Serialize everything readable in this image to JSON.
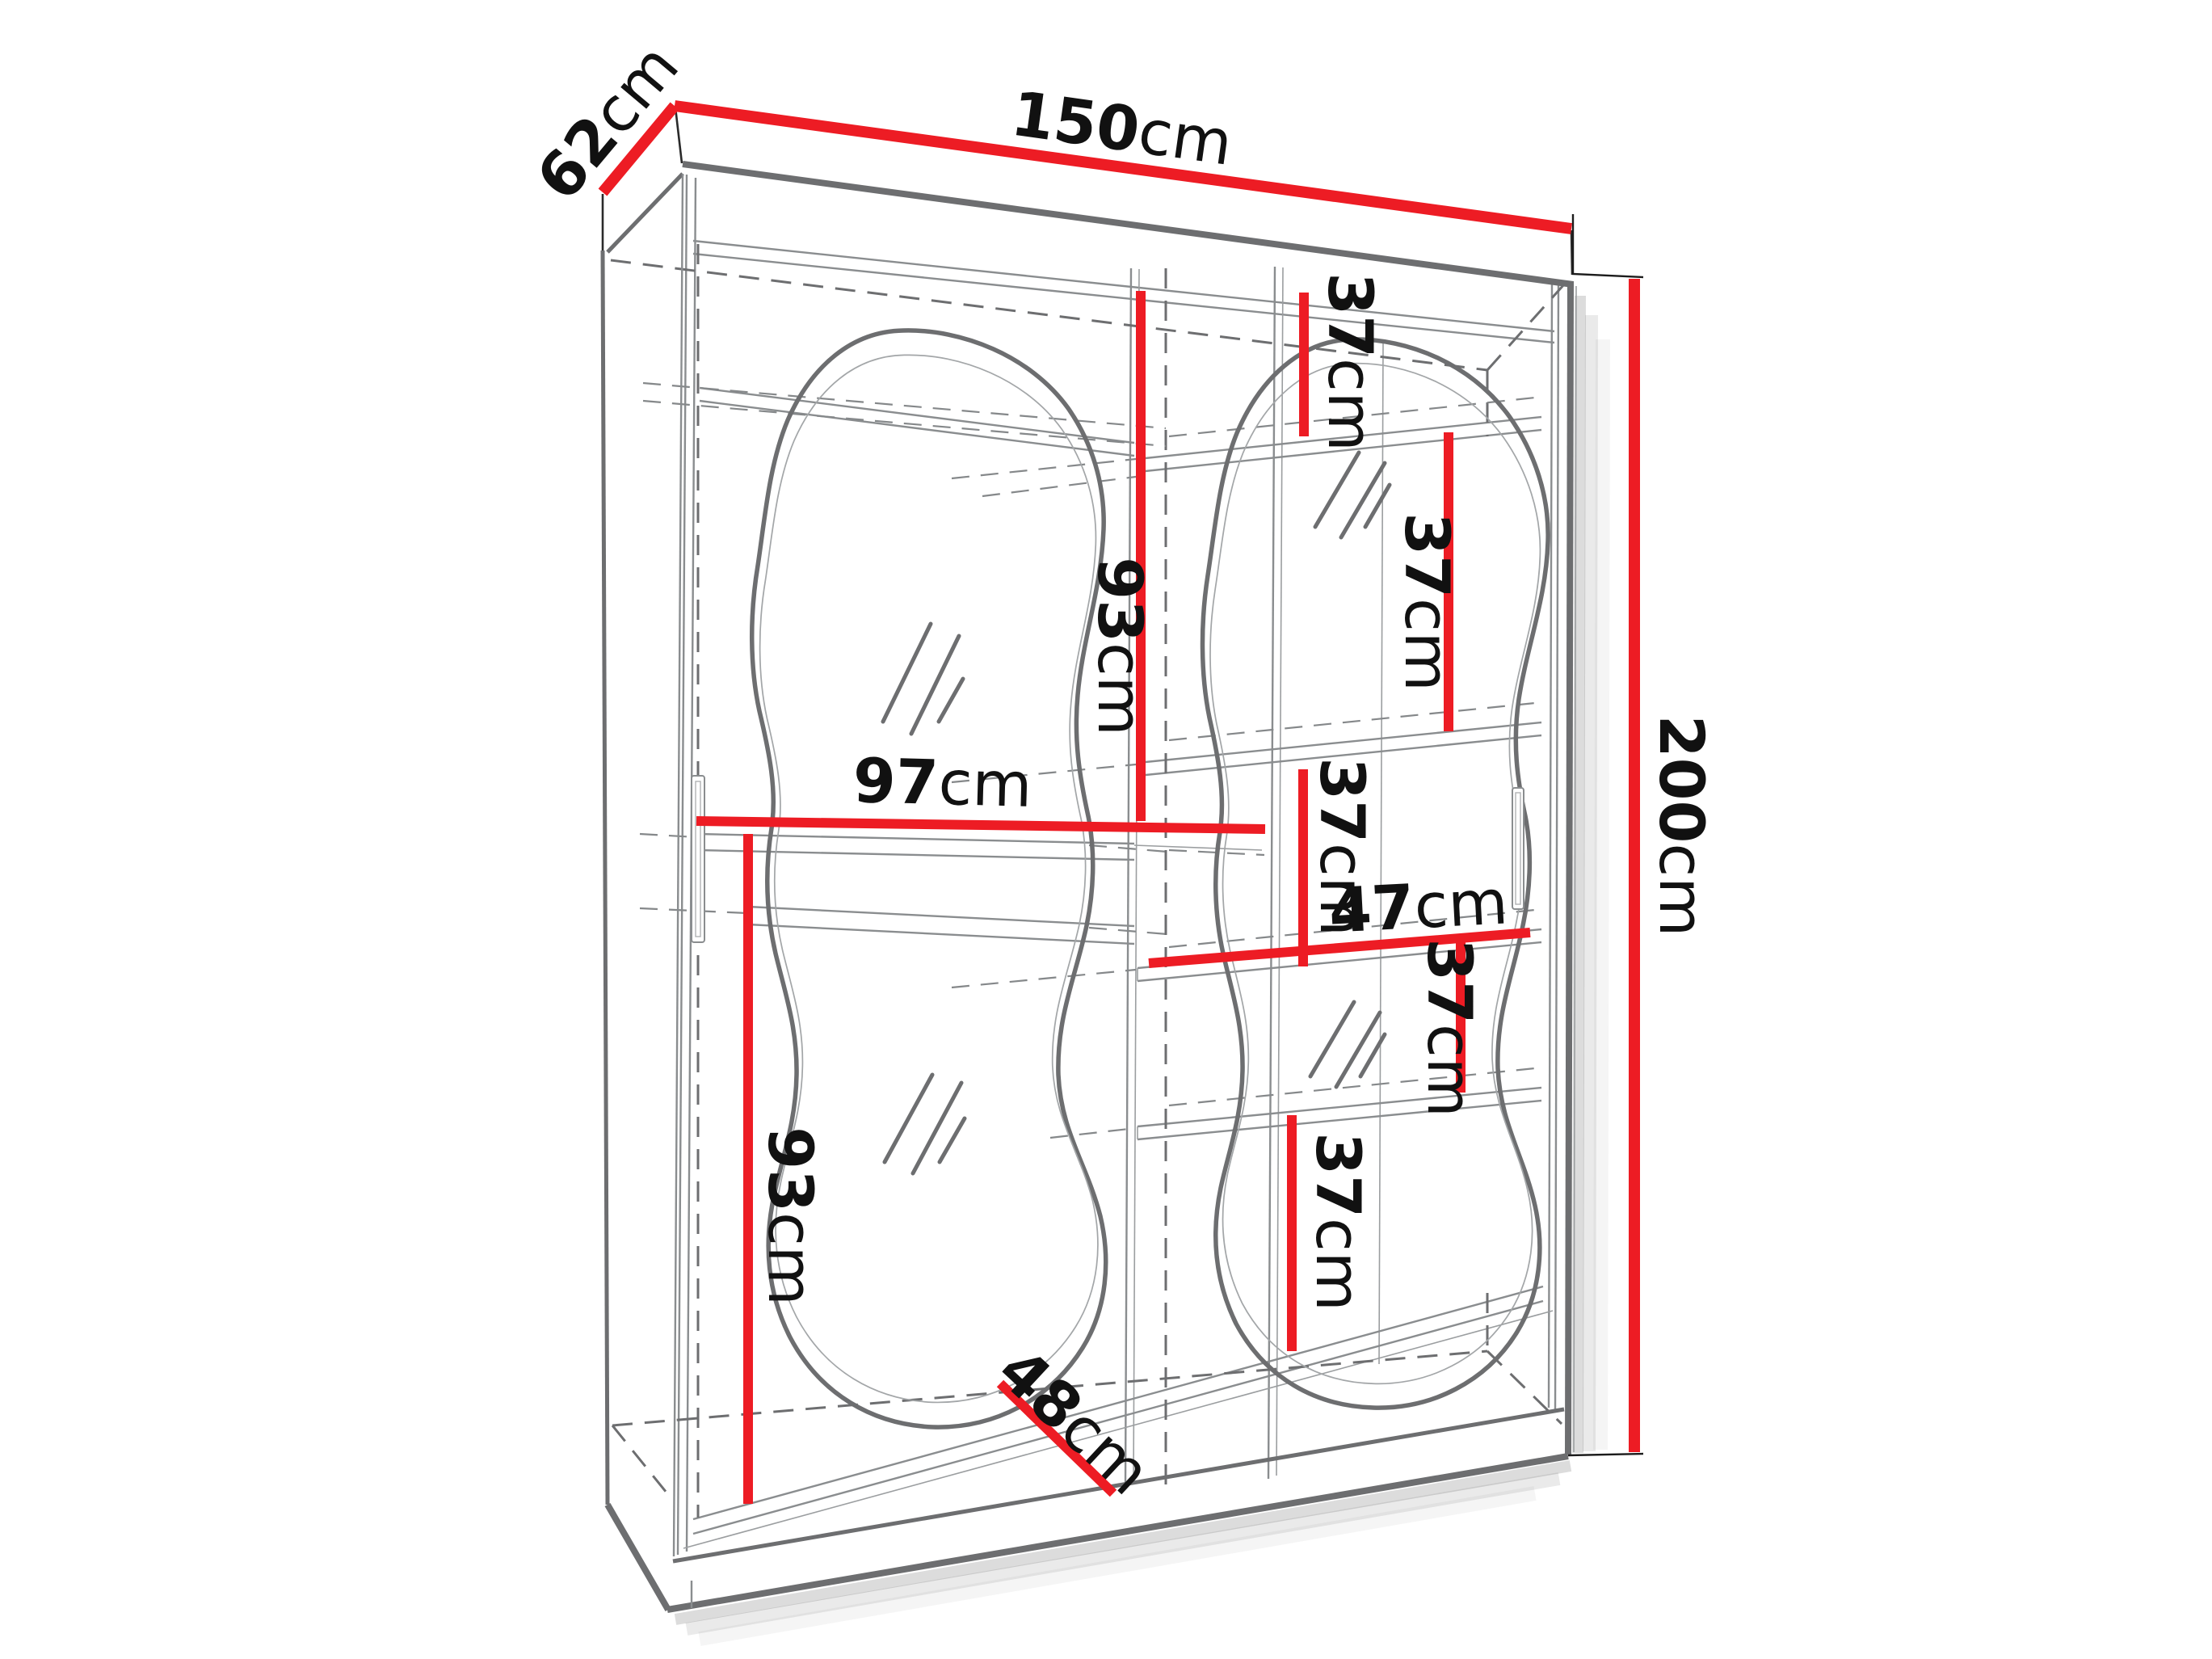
{
  "meta": {
    "type": "furniture-dimension-diagram",
    "subject": "two-door sliding wardrobe with wavy mirrors, perspective line drawing",
    "colors": {
      "accent": "#ed1c24",
      "outline": "#6d6e70",
      "ink": "#111111",
      "bg": "#ffffff"
    }
  },
  "dimensions": {
    "width": {
      "num": "150",
      "unit": "cm"
    },
    "depth": {
      "num": "62",
      "unit": "cm"
    },
    "height": {
      "num": "200",
      "unit": "cm"
    },
    "left_inner_width": {
      "num": "97",
      "unit": "cm"
    },
    "upper_section_height": {
      "num": "93",
      "unit": "cm"
    },
    "lower_section_height": {
      "num": "93",
      "unit": "cm"
    },
    "right_inner_width": {
      "num": "47",
      "unit": "cm"
    },
    "usable_depth": {
      "num": "48",
      "unit": "cm"
    },
    "shelf_gaps": [
      {
        "num": "37",
        "unit": "cm"
      },
      {
        "num": "37",
        "unit": "cm"
      },
      {
        "num": "37",
        "unit": "cm"
      },
      {
        "num": "37",
        "unit": "cm"
      },
      {
        "num": "37",
        "unit": "cm"
      }
    ]
  }
}
